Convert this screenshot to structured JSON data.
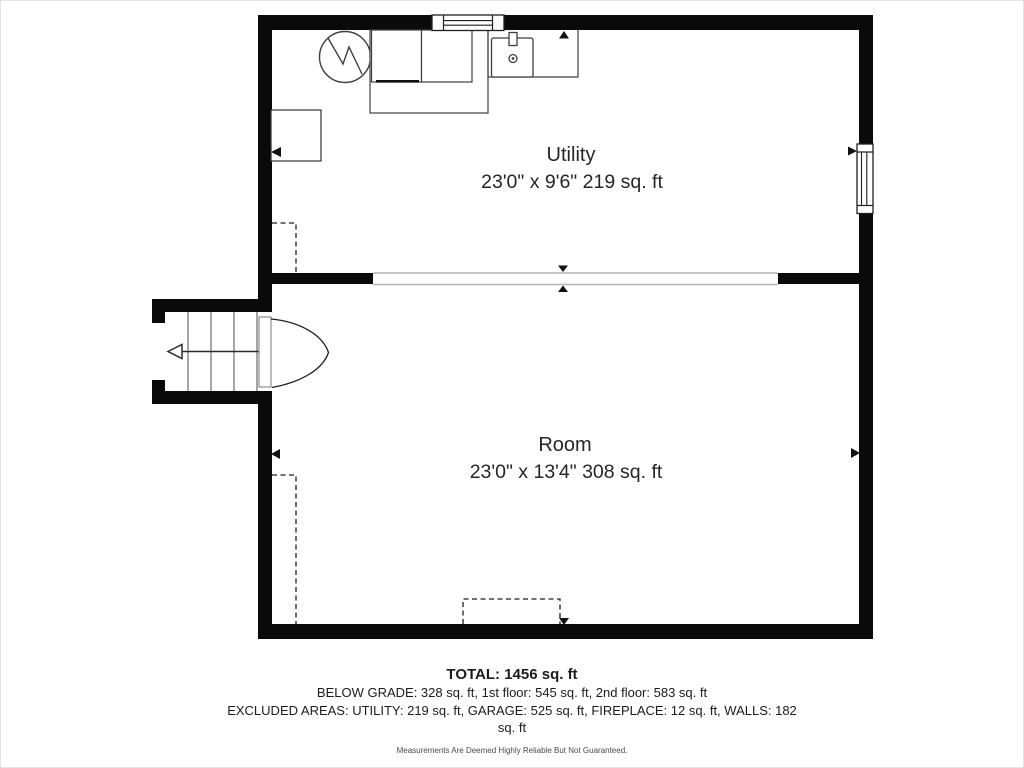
{
  "floorplan": {
    "rooms": {
      "utility": {
        "name": "Utility",
        "dimensions": "23'0\" x 9'6\" 219 sq. ft"
      },
      "room": {
        "name": "Room",
        "dimensions": "23'0\" x 13'4\" 308 sq. ft"
      }
    },
    "summary": {
      "total": "TOTAL: 1456 sq. ft",
      "floors": "BELOW GRADE: 328 sq. ft, 1st floor: 545 sq. ft, 2nd floor: 583 sq. ft",
      "excluded": "EXCLUDED AREAS: UTILITY: 219 sq. ft, GARAGE: 525 sq. ft, FIREPLACE: 12 sq. ft, WALLS: 182 sq. ft",
      "disclaimer": "Measurements Are Deemed Highly Reliable But Not Guaranteed."
    },
    "symbols": {
      "water_heater": "water-heater-icon",
      "washer": "washer-icon",
      "dryer": "dryer-icon",
      "sink": "sink-icon",
      "counter": "counter-outline",
      "window_top": "window-icon",
      "window_right": "window-icon",
      "stairs": "staircase-icon",
      "stairs_direction": "stairs-direction-arrow",
      "door": "door-swing-icon",
      "wall_markers": "wall-arrow-marker",
      "opening_markers": "opening-arrow-marker",
      "closet_dashed": "dashed-area-outline"
    },
    "colors": {
      "wall": "#0a0a0a",
      "fixture_line": "#3f3f3f",
      "opening_line": "#b3b3b3",
      "text": "#262626",
      "disclaimer_text": "#4a4a4a",
      "background": "#ffffff"
    }
  }
}
